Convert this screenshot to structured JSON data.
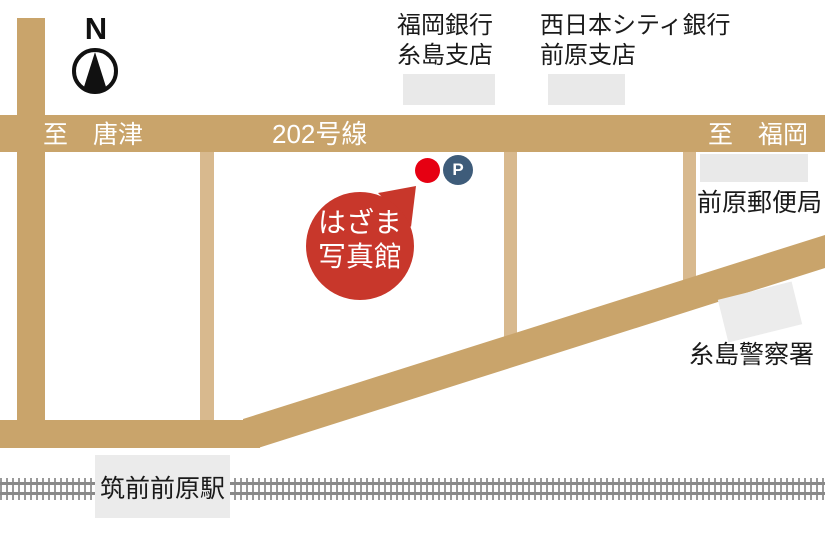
{
  "map": {
    "compass_label": "N",
    "roads": {
      "route_label": "202号線",
      "to_west": "至　唐津",
      "to_east": "至　福岡"
    },
    "landmarks": {
      "bank1_line1": "福岡銀行",
      "bank1_line2": "糸島支店",
      "bank2_line1": "西日本シティ銀行",
      "bank2_line2": "前原支店",
      "post_office": "前原郵便局",
      "police": "糸島警察署",
      "station": "筑前前原駅"
    },
    "shop": {
      "name_line1": "はざま",
      "name_line2": "写真館",
      "parking_label": "P"
    },
    "colors": {
      "road_main": "#C9A46B",
      "road_narrow": "#D8B98E",
      "building_gray": "#E9E9E9",
      "station_box_gray": "#EBEBEB",
      "balloon_red": "#C8372B",
      "marker_red": "#E60012",
      "parking_blue": "#3E5C7A",
      "rail_gray": "#8A8A8A"
    }
  }
}
